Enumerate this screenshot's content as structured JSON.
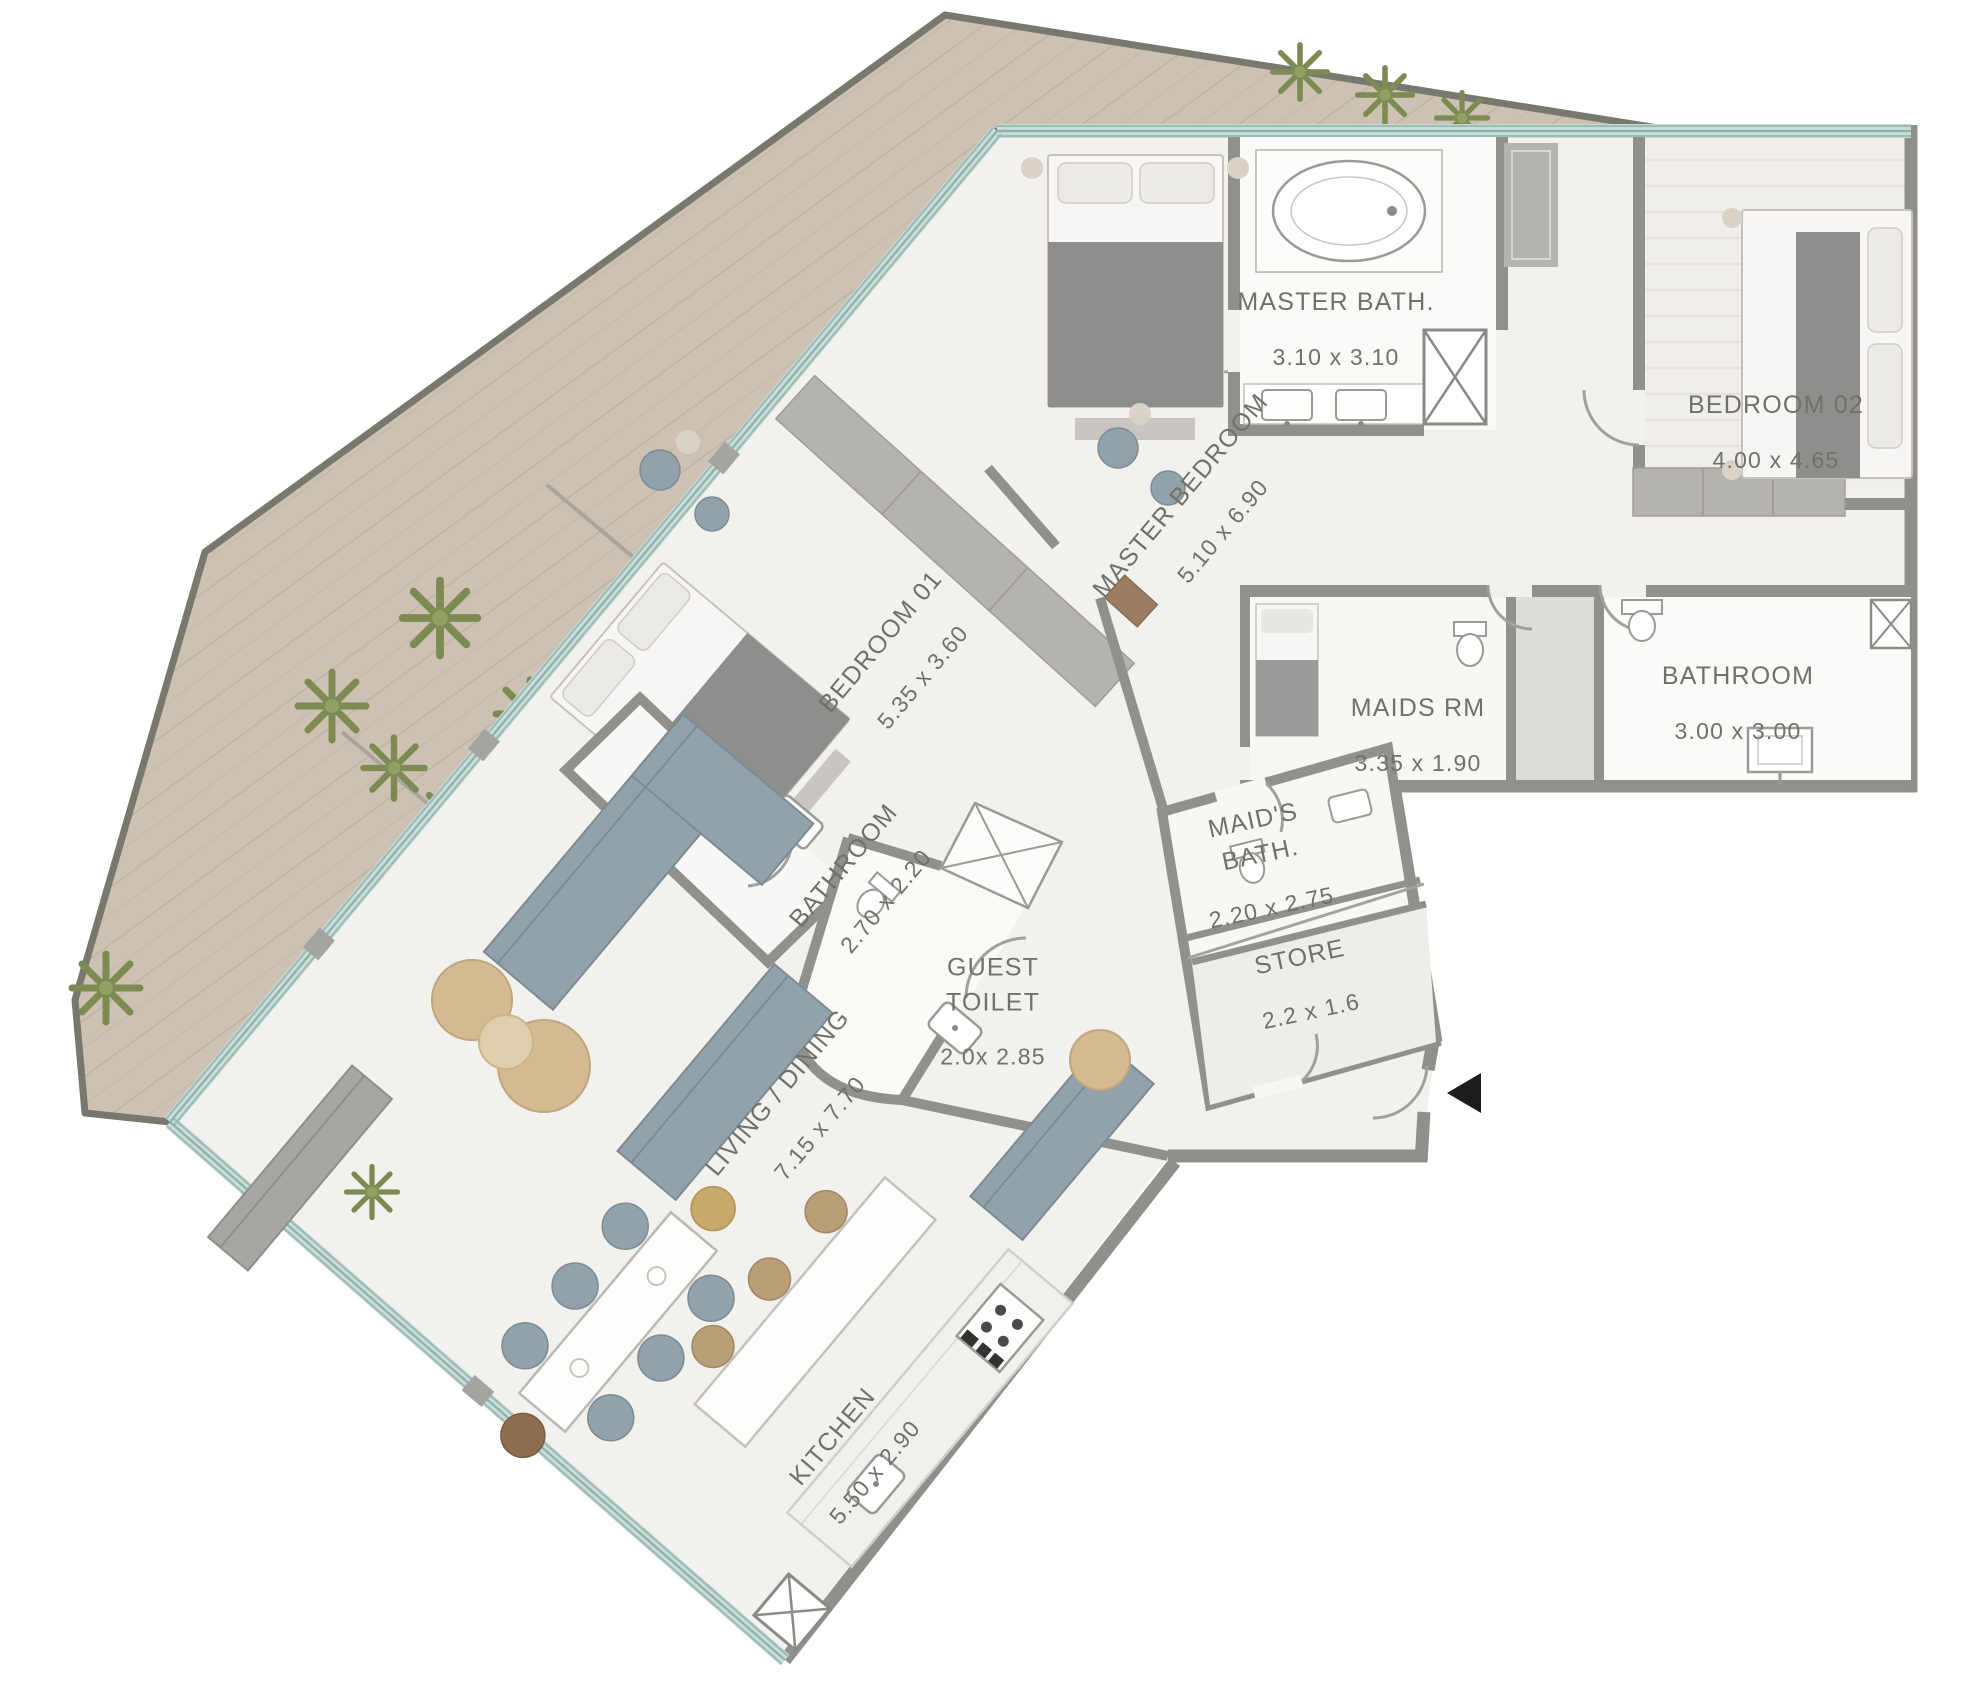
{
  "plan_title": "Apartment Floor Plan",
  "rooms": [
    {
      "id": "master-bath",
      "name": "MASTER BATH.",
      "dims": "3.10 x 3.10"
    },
    {
      "id": "bedroom-02",
      "name": "BEDROOM 02",
      "dims": "4.00 x 4.65"
    },
    {
      "id": "master-bedroom",
      "name": "MASTER BEDROOM",
      "dims": "5.10 x 6.90"
    },
    {
      "id": "bedroom-01",
      "name": "BEDROOM 01",
      "dims": "5.35 x 3.60"
    },
    {
      "id": "maids-room",
      "name": "MAIDS RM",
      "dims": "3.35 x 1.90"
    },
    {
      "id": "bathroom-main",
      "name": "BATHROOM",
      "dims": "3.00 x 3.00"
    },
    {
      "id": "maids-bath",
      "name": "MAID'S BATH.",
      "dims": "2.20 x 2.75"
    },
    {
      "id": "store",
      "name": "STORE",
      "dims": "2.2 x 1.6"
    },
    {
      "id": "bathroom-01",
      "name": "BATHROOM",
      "dims": "2.70 x 2.20"
    },
    {
      "id": "guest-toilet",
      "name": "GUEST TOILET",
      "dims": "2.0x 2.85"
    },
    {
      "id": "living-dining",
      "name": "LIVING / DINING",
      "dims": "7.15 x 7.70"
    },
    {
      "id": "kitchen",
      "name": "KITCHEN",
      "dims": "5.50 x 2.90"
    }
  ],
  "colors": {
    "terrace_wood": "#cdc1b3",
    "wood_grain": "#bfb3a4",
    "glass_wall": "#9dbcb6",
    "wall_gray": "#90908c",
    "floor": "#f2f1ed",
    "wardrobe_gray": "#b5b3ae",
    "furniture_blue": "#93a2aa",
    "blanket_gray": "#8e8e8c",
    "pouf_tan": "#d3ba92",
    "stool_tan": "#b99f78",
    "plant_green": "#7d8b53",
    "door_wood": "#9b7e62",
    "entry_marker": "#1c1c1c"
  }
}
